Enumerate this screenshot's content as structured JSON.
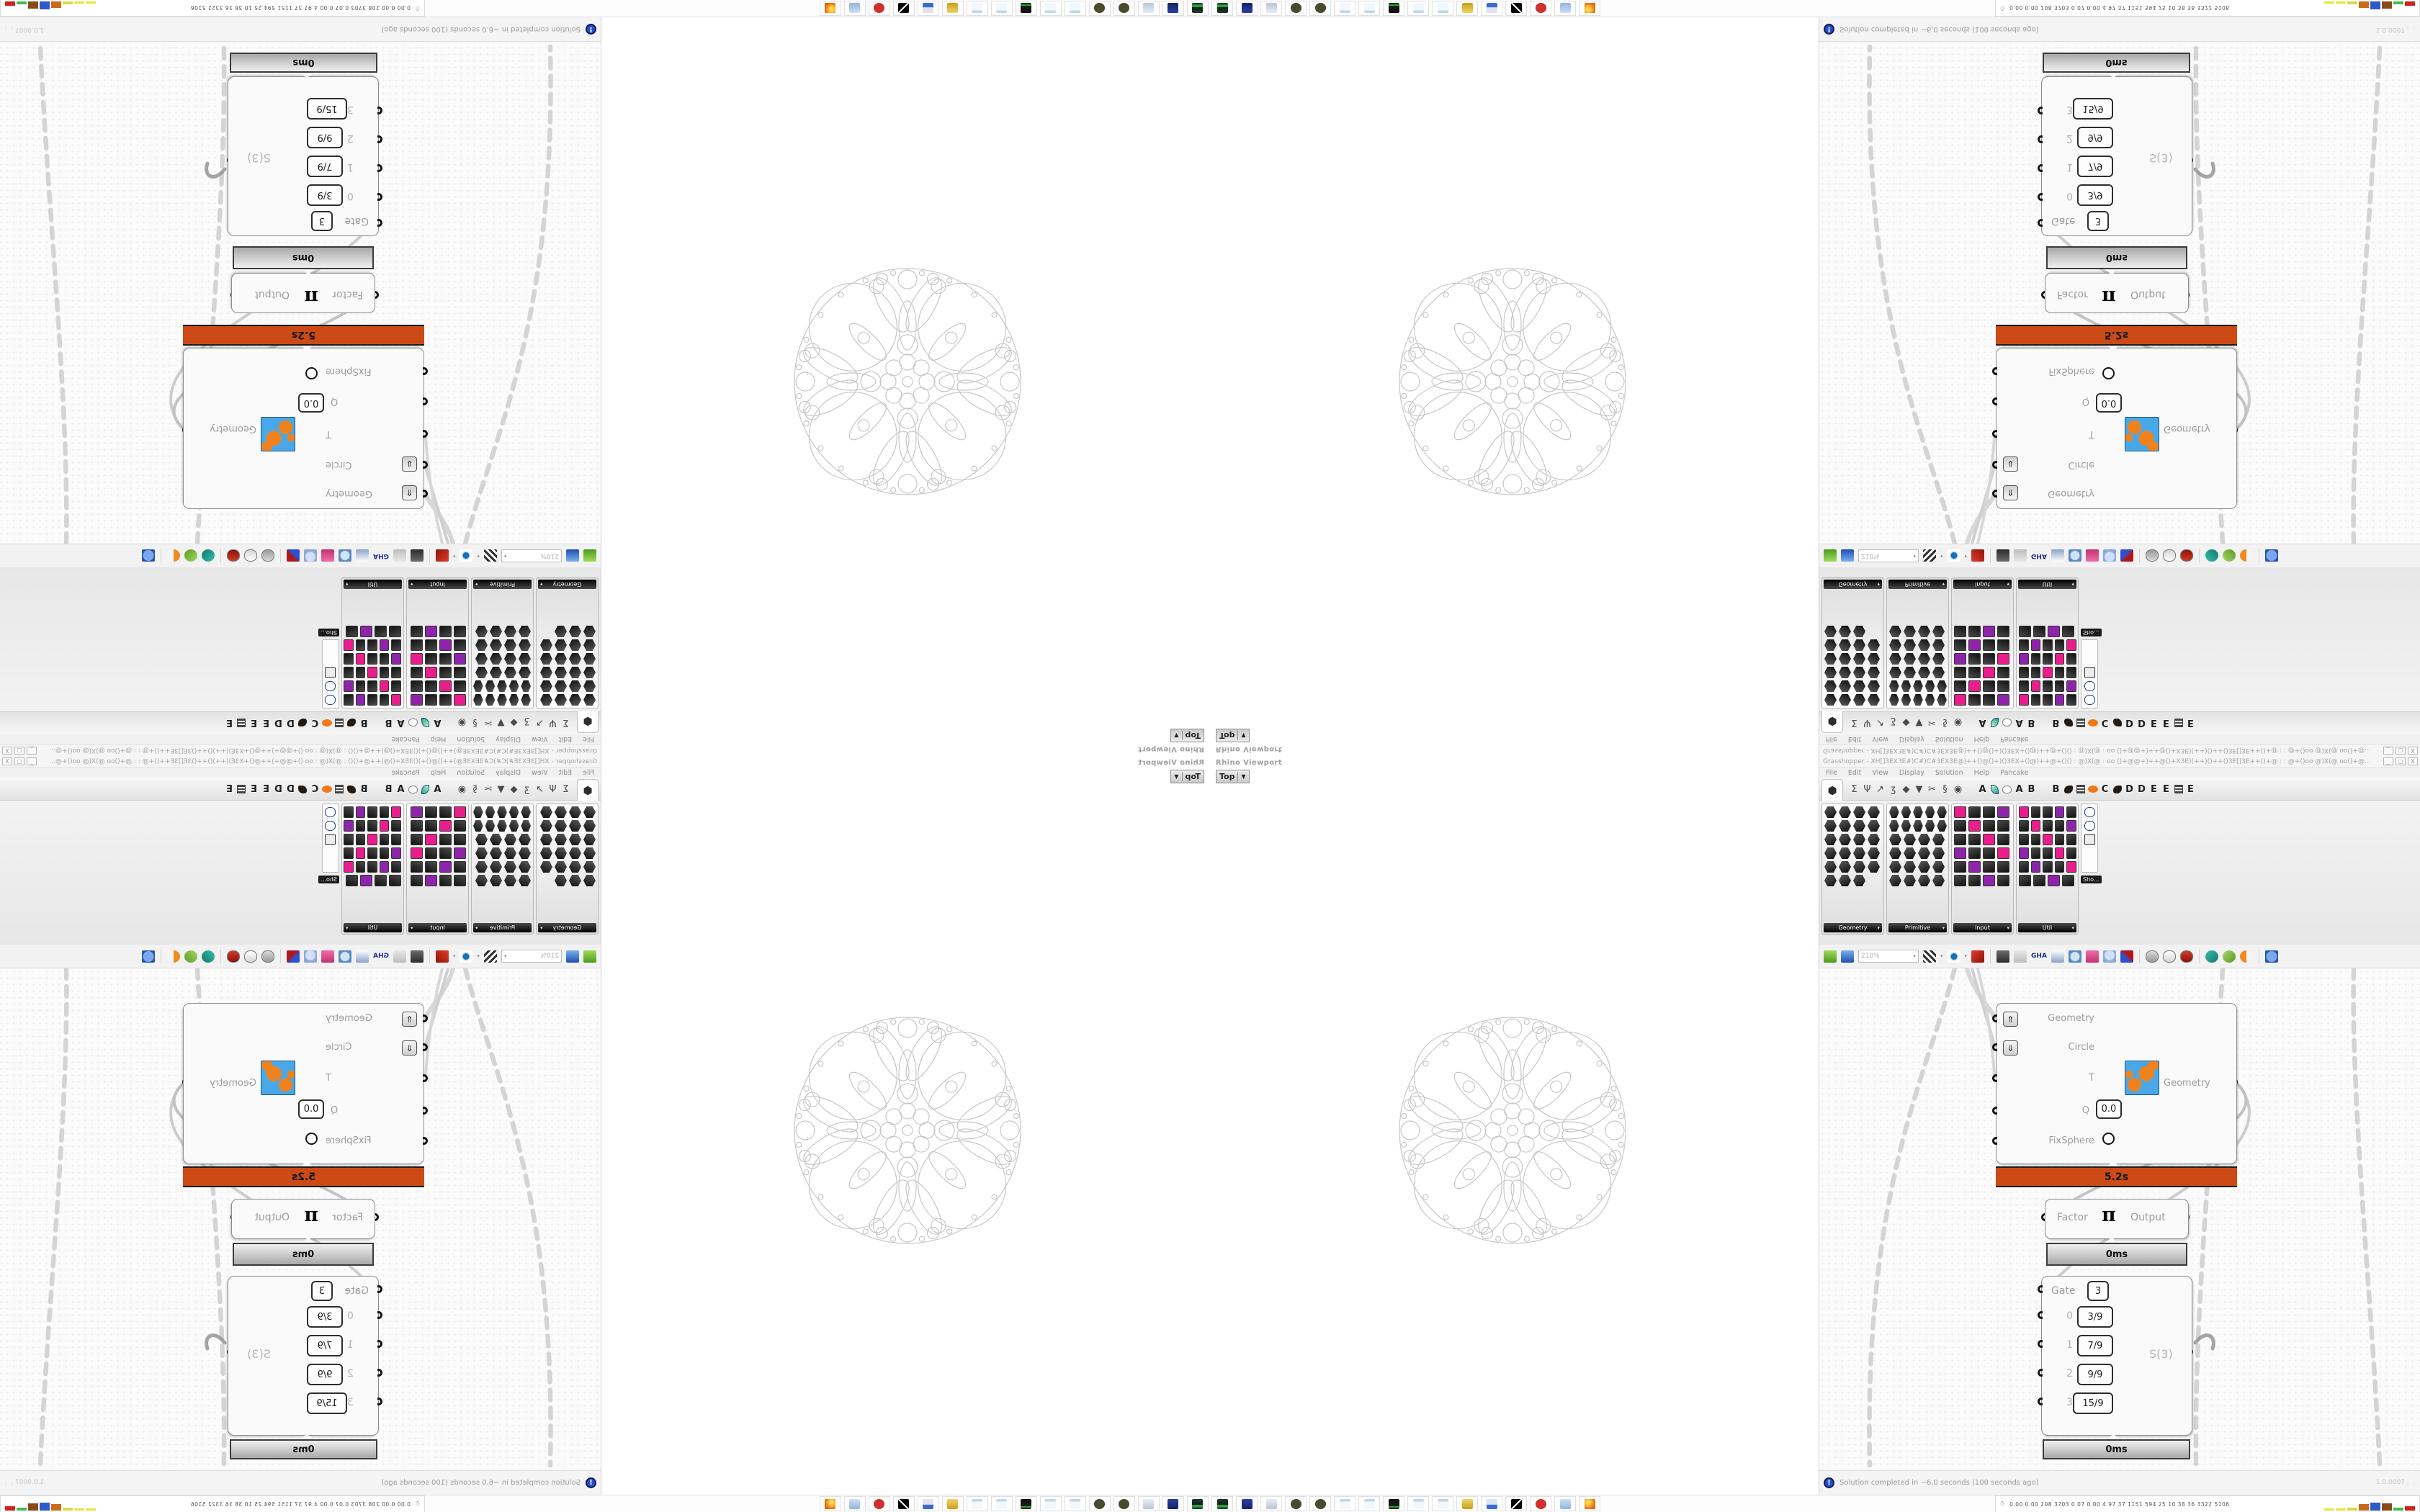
{
  "rhino": {
    "caption": "Rhino Viewport",
    "viewport_tab": "Top",
    "fractal_stroke": "#c7c7ca"
  },
  "gh": {
    "window_title": "Grasshopper - XH[]3EX3E#)C#)C#3EX3E@)++()@()+)()3EX+()@)++@+()()  :  @)X(@  : oo ()+@@+)++@()+X3E)(++)()++()3E[]3E++()+@ : : @+()oo @)X(@ oo()+@++++@()()+X3EX)++()++...",
    "window_buttons": [
      "_",
      "□",
      "X"
    ],
    "menu": [
      "File",
      "Edit",
      "View",
      "Display",
      "Solution",
      "Help",
      "Pancake"
    ],
    "tab_icons": [
      "params-hexagon",
      "maths-sigma",
      "sets-branch",
      "vector-stroke",
      "curve-hook",
      "surface-patch",
      "mesh-funnel",
      "intersect-scissors",
      "transform-spiral",
      "display-eye"
    ],
    "tab_glyphs": [
      "⬢",
      "Σ",
      "Ψ",
      "↗",
      "ʒ",
      "◆",
      "▼",
      "✂",
      "§",
      "◉"
    ],
    "plugin_tabs": [
      "A",
      "leaf-icon",
      "cloud-icon",
      "A",
      "B",
      "mountain-icon",
      "B",
      "bird-icon",
      "grid-icon",
      "ellipse-icon",
      "C",
      "bird-icon",
      "D",
      "D",
      "E",
      "E",
      "grid-icon",
      "E"
    ],
    "palettes": [
      {
        "name": "Geometry",
        "style": "hex",
        "rows": [
          4,
          4,
          4,
          4,
          4,
          3
        ]
      },
      {
        "name": "Primitive",
        "style": "hex",
        "rows": [
          5,
          5,
          4,
          4,
          4,
          4
        ]
      },
      {
        "name": "Input",
        "style": "square",
        "rows": [
          4,
          4,
          4,
          4,
          4,
          4
        ]
      },
      {
        "name": "Util",
        "style": "square",
        "rows": [
          5,
          5,
          5,
          5,
          5,
          4
        ]
      }
    ],
    "palette_popout_label": "Sho...",
    "toolbar": {
      "zoom_level": "210%",
      "gha_label": "GHA",
      "items": [
        "open-button",
        "save-button",
        "zoom-level-box",
        "zoom-extents",
        "preview-eye",
        "sketch-pen",
        "divider",
        "remote-panel",
        "at-panel",
        "gha-installer",
        "window-panel",
        "search-s",
        "package-box",
        "bulb",
        "wire-display",
        "divider",
        "preview-off",
        "preview-wireframe",
        "preview-shaded",
        "divider",
        "select-teal",
        "select-green",
        "select-half",
        "divider",
        "blue-octagon"
      ]
    },
    "canvas": {
      "cluster": {
        "inputs": [
          "Geometry",
          "Circle",
          "T",
          "Q",
          "FixSphere"
        ],
        "q_value": "0.0",
        "output": "Geometry",
        "profiler": "5.2s"
      },
      "pi": {
        "input": "Factor",
        "symbol": "π",
        "output": "Output",
        "profiler": "0ms"
      },
      "gate": {
        "gate_label": "Gate",
        "gate_value": "3",
        "rows": [
          {
            "label": "0",
            "value": "3/9"
          },
          {
            "label": "1",
            "value": "7/9"
          },
          {
            "label": "2",
            "value": "9/9"
          },
          {
            "label": "3",
            "value": "15/9"
          }
        ],
        "output": "S(3)",
        "profiler": "0ms"
      }
    },
    "status": {
      "text": "Solution completed in ~6,0 seconds (100 seconds ago)",
      "version": "1.0.0007"
    }
  },
  "taskbar": {
    "icons": [
      "green-crt-device",
      "floppy-64",
      "scroll-document",
      "dark-ornament",
      "dark-ornament",
      "notepad",
      "notepad",
      "terminal-green",
      "notepad",
      "notepad",
      "folder",
      "workstation",
      "lightning",
      "red-seal",
      "calculator",
      "firefox-browser"
    ],
    "stats_numbers": "0.00  0.00  208  3703  0.07  0.00  4.97  37  1151  594  25  10  38  36  3322 5106",
    "bar_colors": [
      "#e6e63c",
      "#e6e63c",
      "#d9d948",
      "#cc6a1b",
      "#2e59c9",
      "#8a4a17",
      "#3fbb4a",
      "#c9251d"
    ],
    "bar_heights": [
      3,
      3,
      4,
      9,
      11,
      10,
      4,
      6
    ]
  },
  "colors": {
    "profiler_warning": "#cb4a16",
    "wire_dashed": "#d2d2d2",
    "fan_red": "#7a1010",
    "accent_pink": "#e91e8c",
    "accent_yellow": "#ffd32a",
    "accent_green": "#7ed321",
    "accent_purple": "#8e24aa",
    "accent_orange": "#f4511e",
    "accent_blue": "#29b6f6"
  }
}
